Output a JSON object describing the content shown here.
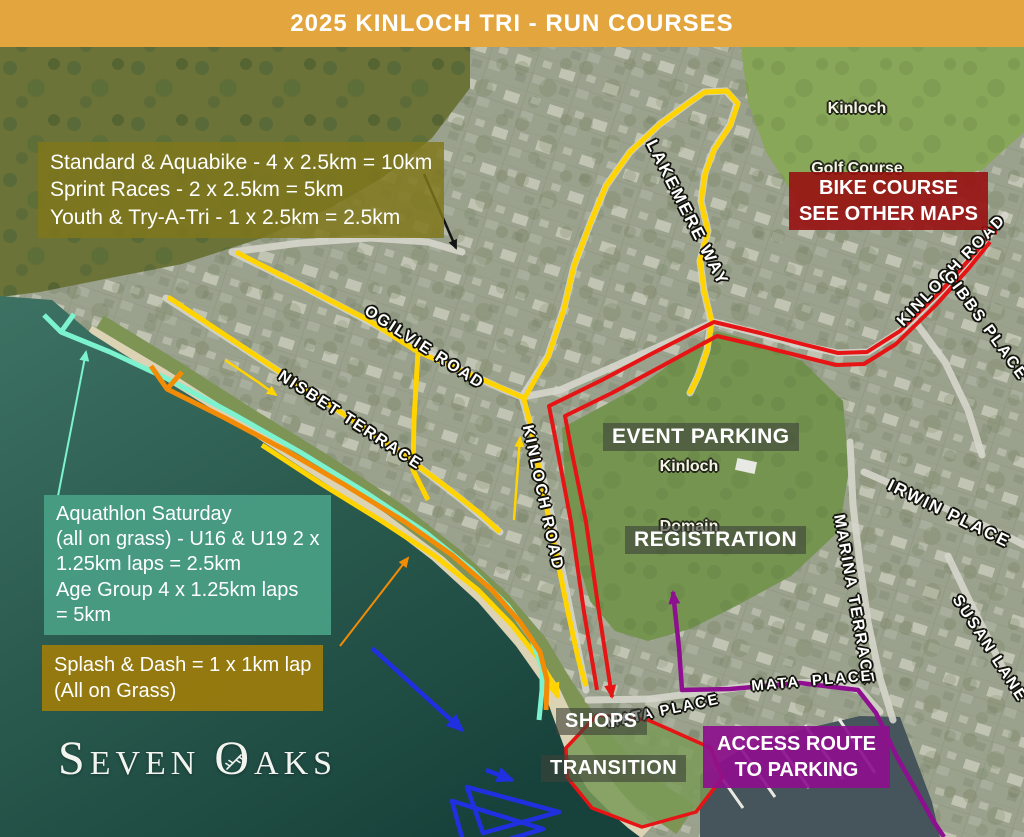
{
  "banner": {
    "title": "2025 KINLOCH TRI - RUN COURSES"
  },
  "boxes": {
    "distances": {
      "lines": [
        "Standard & Aquabike - 4 x 2.5km = 10km",
        "Sprint Races - 2 x 2.5km = 5km",
        "Youth & Try-A-Tri - 1 x 2.5km = 2.5km"
      ]
    },
    "bike_course": {
      "lines": [
        "BIKE COURSE",
        "SEE OTHER MAPS"
      ]
    },
    "aquathlon": {
      "lines": [
        "Aquathlon Saturday",
        "(all on grass) - U16 & U19 2 x",
        "1.25km laps = 2.5km",
        "Age Group 4 x 1.25km laps",
        "= 5km"
      ]
    },
    "splash_dash": {
      "lines": [
        "Splash & Dash = 1 x 1km lap",
        "(All on Grass)"
      ]
    },
    "access_route": {
      "lines": [
        "ACCESS ROUTE",
        "TO PARKING"
      ]
    },
    "event_parking": {
      "label": "EVENT PARKING"
    },
    "registration": {
      "label": "REGISTRATION"
    },
    "shops": {
      "label": "SHOPS"
    },
    "transition": {
      "label": "TRANSITION"
    }
  },
  "roads": {
    "lakemere_way": "LAKEMERE WAY",
    "ogilvie_road": "OGILVIE ROAD",
    "nisbet_terrace": "NISBET TERRACE",
    "kinloch_road_central": "KINLOCH ROAD",
    "kinloch_road_northeast": "KINLOCH ROAD",
    "gibbs_place": "GIBBS PLACE",
    "irwin_place": "IRWIN PLACE",
    "marina_terrace": "MARINA TERRACE",
    "susan_lane": "SUSAN LANE",
    "mata_place_west": "MATA PLACE",
    "mata_place_east": "MATA  PLACE"
  },
  "areas": {
    "golf_course": {
      "lines": [
        "Kinloch",
        "Golf Course"
      ]
    },
    "domain": {
      "lines": [
        "Kinloch",
        "Domain"
      ]
    }
  },
  "logo": {
    "s": "S",
    "even": "EVEN",
    "o": "O",
    "aks": "AKS"
  },
  "colors": {
    "banner_bg": "#E3A53E",
    "run_course_yellow": "#FFD400",
    "aquathlon_teal": "#7CF2CE",
    "splash_dash_orange": "#F28C06",
    "red_route": "#E61414",
    "access_purple": "#8E0F90",
    "swim_blue": "#2030E0",
    "distances_box_bg": "#80771C",
    "bike_box_bg": "#981111",
    "aquathlon_box_bg": "#499F84",
    "splash_box_bg": "#9A7B0D",
    "access_box_bg": "#8D108D",
    "tag_bg": "#3E4238"
  }
}
